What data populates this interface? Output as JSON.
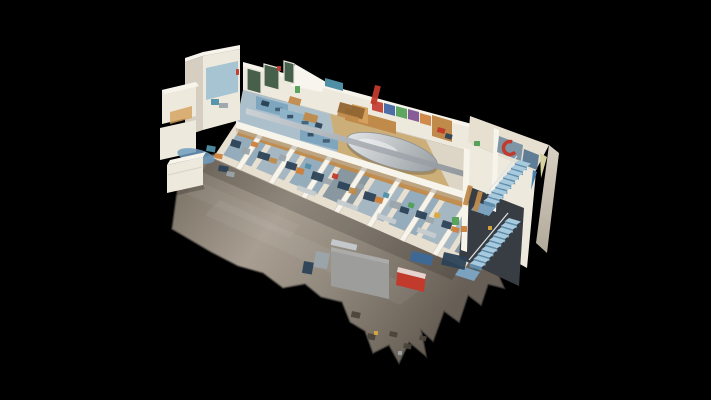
{
  "scene": {
    "description": "3D dollhouse cutaway view of a two-story building interior: gray concrete ground floor apron with jagged scan edges, lower floor of cluttered workstation cells, upper floor with blue bunk beds and a large silver meeting table, colorful mural wall, white scan tower at top left and a blue double staircase wing at right, all floating on a black background.",
    "background": "#000000",
    "palette": {
      "bg": "#000000",
      "concrete": "#938a7e",
      "concrete_light": "#a89e91",
      "concrete_dark": "#6e665c",
      "wall": "#eee9dd",
      "wall_bright": "#f7f4ec",
      "wall_shadow": "#d6cfc1",
      "cream": "#e7e0d1",
      "wood": "#c08a4a",
      "wood_light": "#d4a05c",
      "wood_dark": "#8f6530",
      "carpet": "#8ba6b8",
      "carpet2": "#9db3c0",
      "slate": "#7d8f9a",
      "bed_blue": "#7fa6bf",
      "bed_blue2": "#8eb4c9",
      "navy": "#2c4257",
      "steel": "#9aa4ab",
      "silver": "#c6cbcf",
      "duct": "#b4bac0",
      "stair_tread": "#a8cade",
      "stair_riser": "#5f8dab",
      "stair_string": "#3e5f78",
      "landing": "#7ba3c0",
      "red": "#c13a2c",
      "teal": "#4f8fa6",
      "green": "#4f9f55",
      "yellow": "#d9a83c",
      "orange": "#cd7f3a",
      "purple": "#7a4e8f",
      "mural_blue": "#3a5fa0",
      "window_dark": "#34312a",
      "window_green": "#46604c",
      "unscanned": "#9d9d9b",
      "opening": "#383d43",
      "art_panel": "#7e95a6",
      "art_panel2": "#5f7d96",
      "flag": "#d8d2a0",
      "blue_mat": "#3c6998",
      "blue_mat2": "#2f5b8c",
      "fringe": "#4a443b",
      "tower_interior": "#9fc0d0"
    },
    "lower_band": {
      "beam": [
        238,
        120,
        505,
        205
      ],
      "front": [
        213,
        158,
        465,
        268
      ]
    },
    "partitions": {
      "ts": [
        0.09,
        0.22,
        0.35,
        0.48,
        0.61,
        0.74,
        0.87
      ],
      "w": 5,
      "color": "wall_bright"
    },
    "floor_patches": {
      "span": 0.11,
      "inset_back": 0.2,
      "inset_front": 0.85,
      "items": [
        [
          0.025,
          "carpet"
        ],
        [
          0.155,
          "carpet2"
        ],
        [
          0.285,
          "carpet"
        ],
        [
          0.415,
          "slate"
        ],
        [
          0.545,
          "carpet2"
        ],
        [
          0.675,
          "carpet"
        ],
        [
          0.805,
          "carpet2"
        ],
        [
          0.935,
          "slate"
        ]
      ]
    },
    "window_groups": [
      {
        "name": "back-wall-windows",
        "slope": 0.27,
        "glass": "window_green",
        "frame": "#e9e5da",
        "items": [
          [
            247,
            68,
            14,
            22
          ],
          [
            264,
            64,
            15,
            22
          ],
          [
            284,
            61,
            10,
            20
          ]
        ]
      },
      {
        "name": "tower-window",
        "slope": -0.17,
        "glass": "window_dark",
        "frame": "#cfc9bd",
        "items": [
          [
            206,
            54,
            26,
            10
          ]
        ]
      },
      {
        "name": "wing-a-windows",
        "slope": -0.235,
        "glass": "window_dark",
        "frame": "#8a6a42",
        "items": [
          [
            165,
            96,
            14,
            20
          ],
          [
            182,
            92,
            11,
            20
          ]
        ]
      },
      {
        "name": "wing-b-windows",
        "slope": -0.235,
        "glass": "window_dark",
        "frame": "#8a6a42",
        "items": [
          [
            164,
            134,
            14,
            18
          ],
          [
            181,
            130,
            11,
            18
          ]
        ]
      }
    ],
    "murals": {
      "slope": 0.27,
      "w": 11,
      "h": 10,
      "items": [
        [
          372,
          100,
          "red"
        ],
        [
          384,
          103,
          "mural_blue"
        ],
        [
          396,
          106,
          "green"
        ],
        [
          408,
          109,
          "purple"
        ],
        [
          420,
          113,
          "orange"
        ],
        [
          432,
          116,
          "teal"
        ]
      ]
    },
    "beds": {
      "slope": 0.27,
      "items": [
        [
          256,
          96,
          32,
          13,
          "bed_blue"
        ],
        [
          280,
          108,
          36,
          14,
          "bed_blue2"
        ],
        [
          300,
          126,
          38,
          14,
          "bed_blue"
        ]
      ]
    },
    "stairs": {
      "flights": [
        {
          "x": 519,
          "y": 160,
          "n": 9,
          "dx": -3.9,
          "dy": 4.7
        },
        {
          "x": 509,
          "y": 218,
          "n": 10,
          "dx": -3.9,
          "dy": 4.7
        }
      ]
    },
    "clutter": [
      [
        232,
        139,
        10,
        7,
        "navy",
        17
      ],
      [
        243,
        147,
        8,
        6,
        "steel",
        17
      ],
      [
        252,
        141,
        7,
        5,
        "orange",
        17
      ],
      [
        259,
        151,
        12,
        7,
        "navy",
        17
      ],
      [
        270,
        157,
        8,
        5,
        "wood",
        17
      ],
      [
        280,
        154,
        7,
        6,
        "steel",
        17
      ],
      [
        287,
        161,
        11,
        7,
        "navy",
        17
      ],
      [
        297,
        167,
        8,
        6,
        "orange",
        17
      ],
      [
        306,
        163,
        6,
        5,
        "teal",
        17
      ],
      [
        313,
        171,
        12,
        8,
        "navy",
        17
      ],
      [
        324,
        177,
        9,
        6,
        "steel",
        17
      ],
      [
        333,
        173,
        6,
        5,
        "red",
        17
      ],
      [
        339,
        181,
        12,
        7,
        "navy",
        17
      ],
      [
        350,
        187,
        8,
        6,
        "wood",
        17
      ],
      [
        358,
        183,
        7,
        5,
        "steel",
        17
      ],
      [
        365,
        191,
        12,
        8,
        "navy",
        17
      ],
      [
        376,
        196,
        8,
        6,
        "orange",
        17
      ],
      [
        384,
        192,
        6,
        5,
        "teal",
        17
      ],
      [
        391,
        200,
        11,
        7,
        "steel",
        17
      ],
      [
        401,
        206,
        9,
        6,
        "navy",
        17
      ],
      [
        409,
        202,
        6,
        5,
        "green",
        17
      ],
      [
        417,
        210,
        11,
        7,
        "navy",
        17
      ],
      [
        427,
        216,
        8,
        6,
        "steel",
        17
      ],
      [
        435,
        212,
        6,
        5,
        "yellow",
        17
      ],
      [
        443,
        220,
        10,
        7,
        "navy",
        17
      ],
      [
        452,
        226,
        8,
        5,
        "orange",
        17
      ],
      [
        298,
        185,
        20,
        5,
        "silver",
        20
      ],
      [
        338,
        199,
        22,
        5,
        "silver",
        20
      ],
      [
        378,
        213,
        20,
        5,
        "silver",
        20
      ],
      [
        418,
        227,
        20,
        5,
        "silver",
        20
      ],
      [
        262,
        100,
        8,
        5,
        "navy",
        16
      ],
      [
        290,
        96,
        12,
        7,
        "wood",
        16
      ],
      [
        305,
        112,
        14,
        8,
        "wood",
        16
      ],
      [
        316,
        122,
        7,
        5,
        "navy",
        16
      ],
      [
        340,
        102,
        26,
        11,
        "wood_dark",
        15
      ],
      [
        338,
        112,
        22,
        4,
        "wood",
        15
      ],
      [
        438,
        127,
        8,
        5,
        "red",
        16
      ],
      [
        446,
        133,
        7,
        5,
        "navy",
        16
      ],
      [
        295,
        86,
        5,
        7,
        "green",
        0
      ],
      [
        474,
        141,
        6,
        5,
        "green",
        0
      ],
      [
        207,
        145,
        9,
        6,
        "teal",
        10
      ],
      [
        215,
        153,
        8,
        5,
        "orange",
        10
      ],
      [
        219,
        165,
        10,
        6,
        "navy",
        10
      ],
      [
        227,
        171,
        8,
        5,
        "steel",
        10
      ],
      [
        316,
        251,
        14,
        16,
        "steel",
        10
      ],
      [
        304,
        261,
        10,
        12,
        "navy",
        10
      ],
      [
        332,
        239,
        26,
        6,
        "silver",
        13
      ],
      [
        412,
        251,
        22,
        10,
        "blue_mat",
        13
      ],
      [
        444,
        252,
        24,
        13,
        "navy",
        13
      ],
      [
        452,
        217,
        7,
        8,
        "green",
        0
      ],
      [
        461,
        226,
        6,
        6,
        "orange",
        0
      ],
      [
        488,
        226,
        4,
        4,
        "yellow",
        0
      ],
      [
        468,
        185,
        5,
        20,
        "wood",
        15
      ],
      [
        478,
        191,
        5,
        20,
        "wood",
        15
      ],
      [
        211,
        99,
        8,
        6,
        "teal",
        0
      ],
      [
        219,
        103,
        9,
        5,
        "steel",
        0
      ],
      [
        236,
        69,
        3,
        6,
        "red",
        0
      ],
      [
        277,
        66,
        4,
        5,
        "red",
        0
      ],
      [
        375,
        85,
        6,
        19,
        "red",
        14
      ],
      [
        352,
        311,
        9,
        6,
        "fringe",
        12
      ],
      [
        368,
        333,
        8,
        6,
        "fringe",
        12
      ],
      [
        390,
        331,
        8,
        5,
        "fringe",
        12
      ],
      [
        404,
        343,
        8,
        5,
        "fringe",
        12
      ],
      [
        420,
        335,
        7,
        5,
        "fringe",
        12
      ],
      [
        374,
        331,
        4,
        4,
        "yellow",
        0
      ],
      [
        398,
        351,
        4,
        4,
        "steel",
        0
      ]
    ]
  }
}
